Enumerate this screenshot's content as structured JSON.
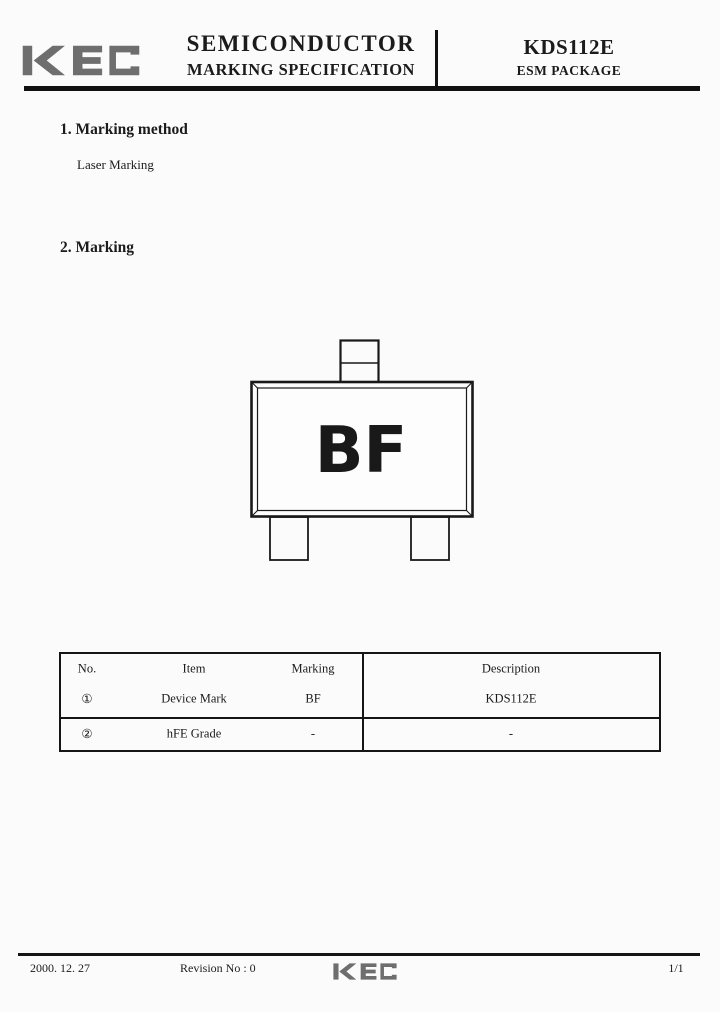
{
  "header": {
    "logo": "KEC",
    "title_line1": "SEMICONDUCTOR",
    "title_line2": "MARKING SPECIFICATION",
    "part_number": "KDS112E",
    "package": "ESM PACKAGE"
  },
  "sections": {
    "s1_heading": "1. Marking method",
    "s1_body": "Laser Marking",
    "s2_heading": "2. Marking"
  },
  "diagram": {
    "marking_text": "BF"
  },
  "table": {
    "headers": [
      "No.",
      "Item",
      "Marking",
      "Description"
    ],
    "rows": [
      {
        "no": "①",
        "item": "Device Mark",
        "marking": "BF",
        "description": "KDS112E"
      },
      {
        "no": "②",
        "item": "hFE Grade",
        "marking": "-",
        "description": "-"
      }
    ]
  },
  "footer": {
    "date": "2000. 12. 27",
    "revision": "Revision No : 0",
    "logo": "KEC",
    "page_number": "1/1"
  },
  "colors": {
    "logo_gray": "#6e6e6e",
    "ink": "#1b1b1b",
    "paper": "#fbfbfb"
  }
}
